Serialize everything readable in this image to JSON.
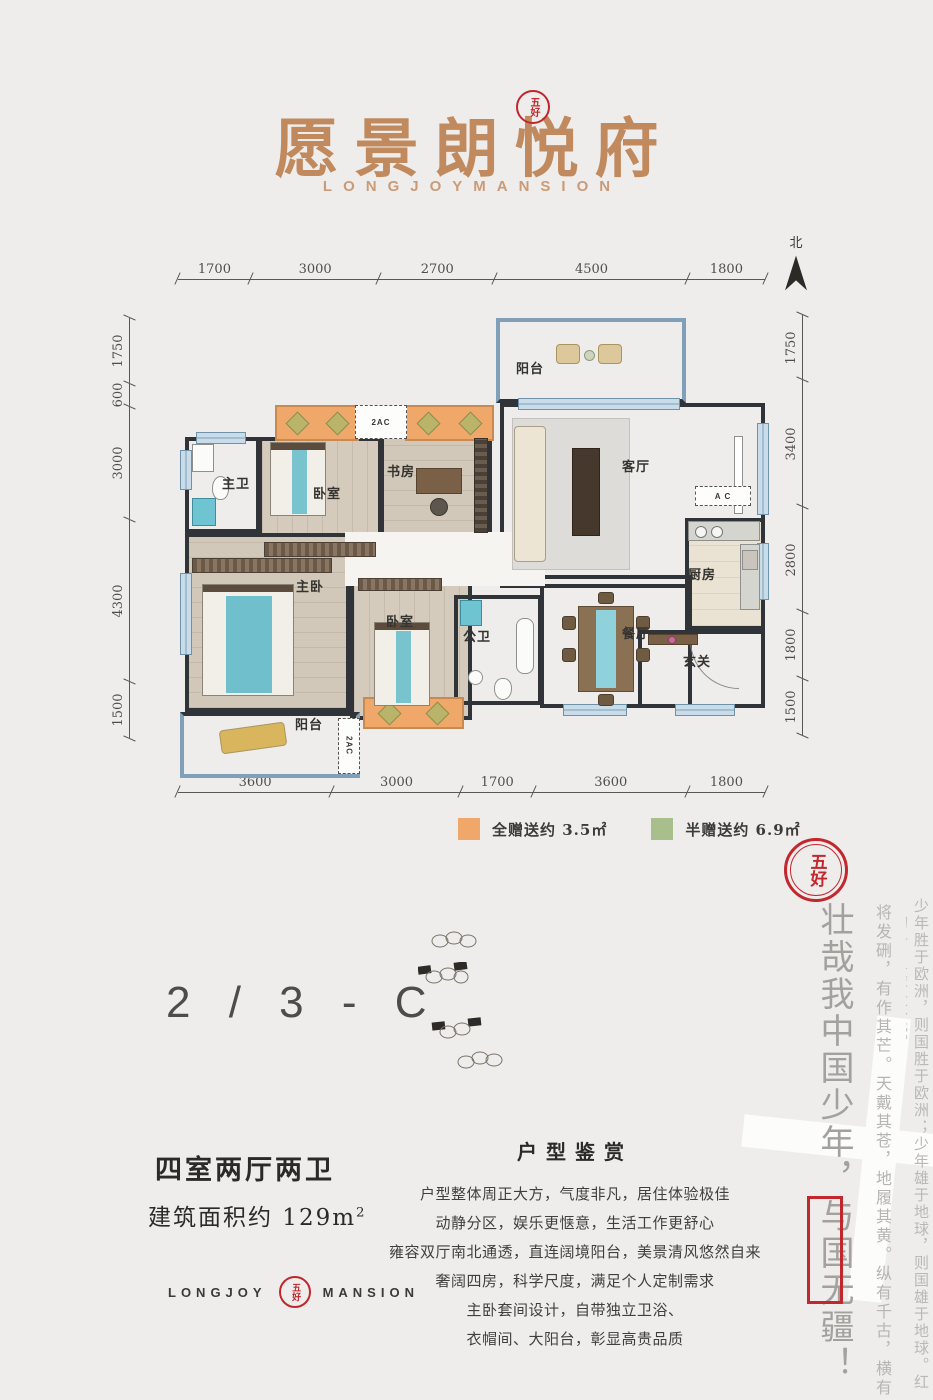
{
  "brand": {
    "logo_cn": "愿景朗悦府",
    "logo_en": "LONGJOYMANSION",
    "seal_text": "五好",
    "footer_word_left": "LONGJOY",
    "footer_word_right": "MANSION"
  },
  "compass": {
    "label": "北"
  },
  "dimensions": {
    "top": [
      "1700",
      "3000",
      "2700",
      "4500",
      "1800"
    ],
    "bottom": [
      "3600",
      "3000",
      "1700",
      "3600",
      "1800"
    ],
    "left": [
      "1750",
      "600",
      "3000",
      "4300",
      "1500"
    ],
    "right": [
      "1750",
      "3400",
      "2800",
      "1800",
      "1500"
    ]
  },
  "rooms": {
    "balcony_top": "阳台",
    "living": "客厅",
    "kitchen": "厨房",
    "foyer": "玄关",
    "dining": "餐厅",
    "master_bath": "主卫",
    "bedroom2": "卧室",
    "study": "书房",
    "master_bedroom": "主卧",
    "bedroom3": "卧室",
    "public_bath": "公卫",
    "balcony_bottom": "阳台",
    "ac_top": "2AC",
    "ac_bottom": "2AC",
    "ac_right": "A C"
  },
  "legend": {
    "full_gift": {
      "label": "全赠送约 3.5㎡",
      "color": "#efa76a"
    },
    "half_gift": {
      "label": "半赠送约 6.9㎡",
      "color": "#a9bf8b"
    }
  },
  "unit": {
    "code": "2 / 3 - C",
    "layout": "四室两厅两卫",
    "area_label": "建筑面积约 129m",
    "area_sup": "2"
  },
  "appreciation": {
    "title": "户型鉴赏",
    "lines": [
      "户型整体周正大方，气度非凡，居住体验极佳",
      "动静分区，娱乐更惬意，生活工作更舒心",
      "雍容双厅南北通透，直连阔境阳台，美景清风悠然自来",
      "奢阔四房，科学尺度，满足个人定制需求",
      "主卧套间设计，自带独立卫浴、",
      "衣帽间、大阳台，彰显高贵品质"
    ]
  },
  "calligraphy": {
    "seal": "五好",
    "main": "壮哉我中国少年，与国无疆！",
    "col2": "将发硎，有作其芒。天戴其苍，地履其黄。纵有千古，横有八荒。",
    "col3": "少年胜于欧洲，则国胜于欧洲；少年雄于地球，则国雄于地球。红日初升，其道大光。",
    "watermark": "十"
  }
}
